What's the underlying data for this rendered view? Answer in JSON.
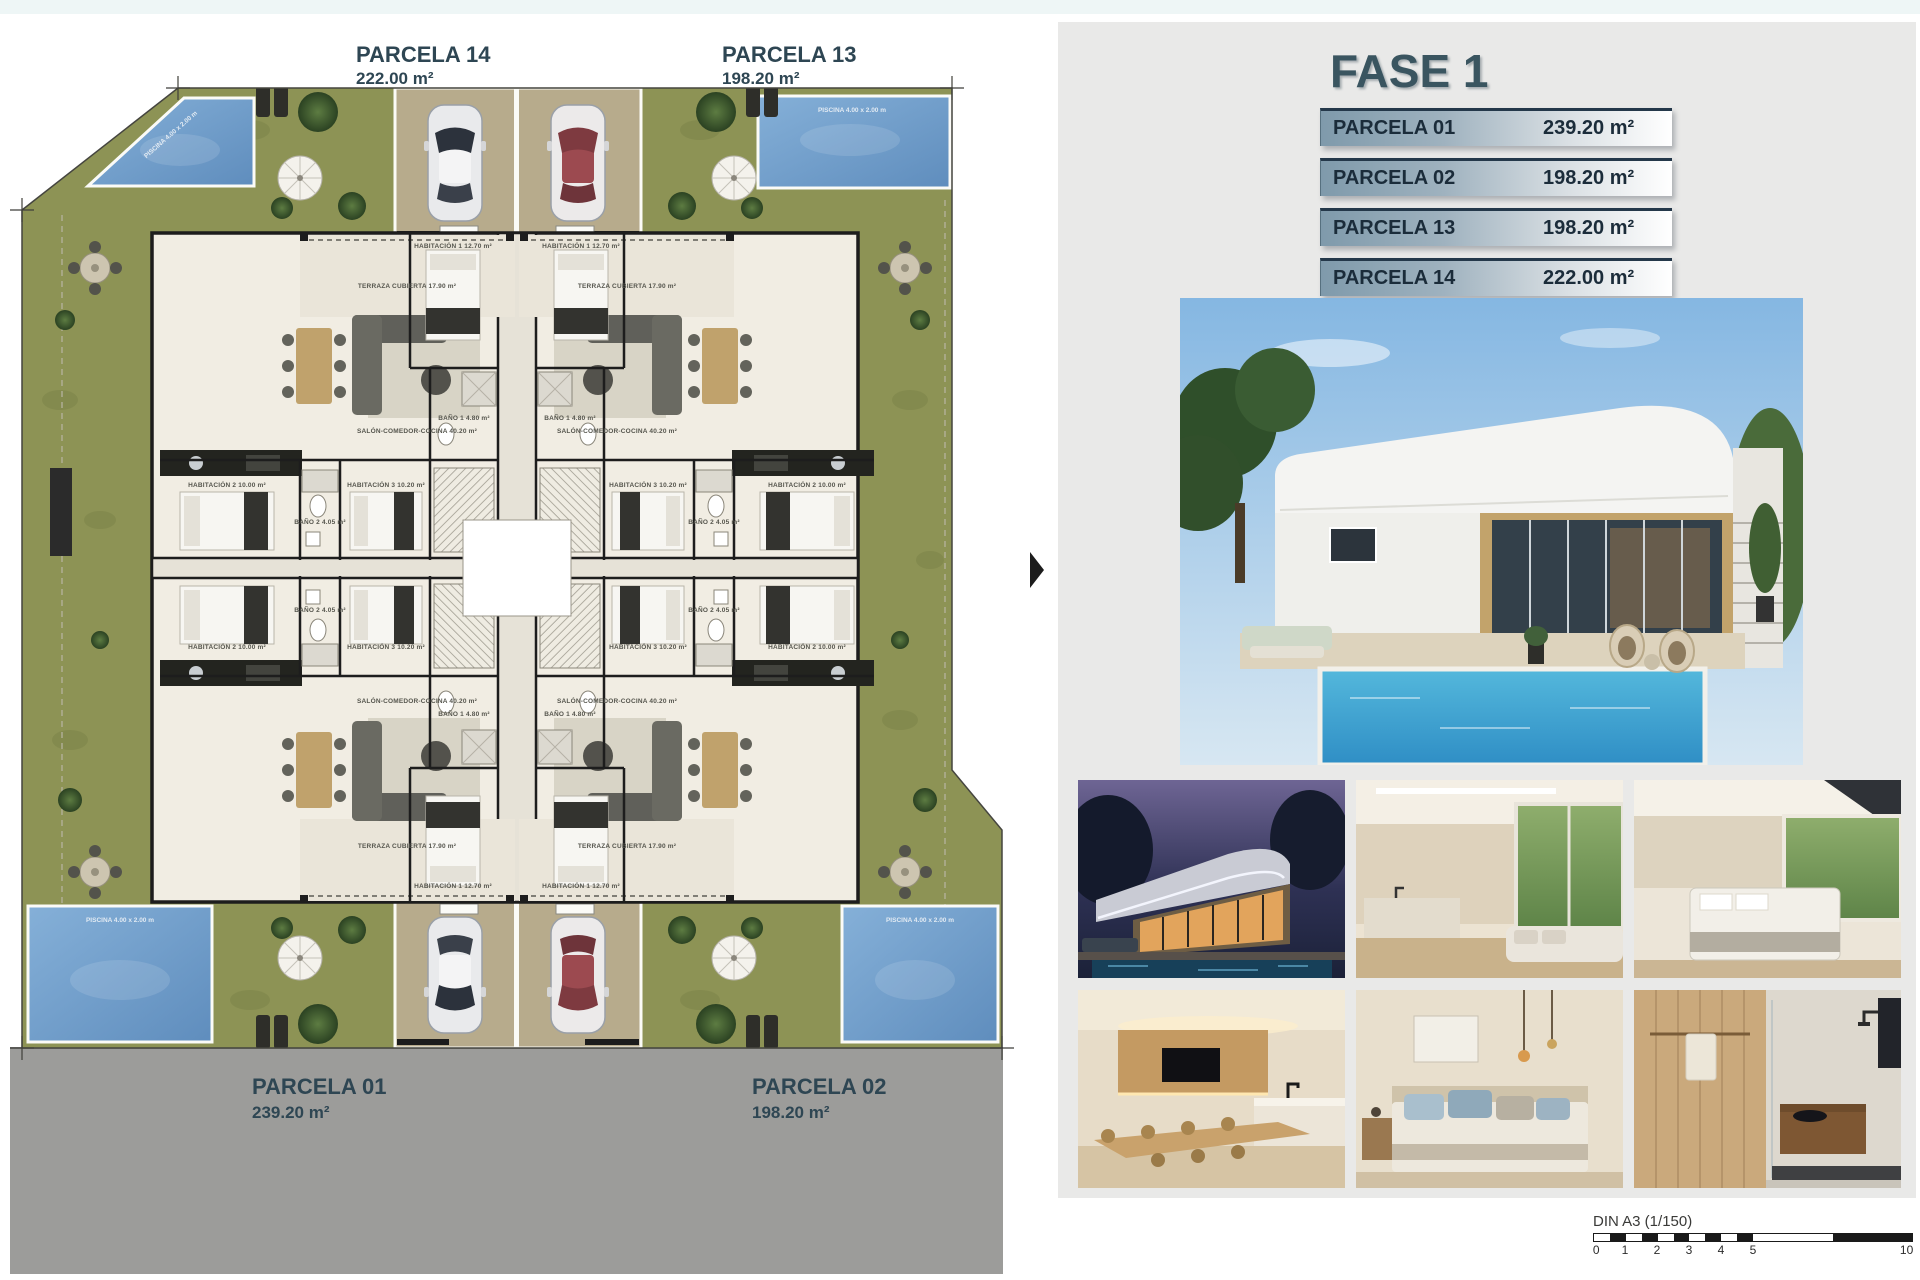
{
  "plan": {
    "parcels": [
      {
        "name": "PARCELA 14",
        "area": "222.00 m²"
      },
      {
        "name": "PARCELA 13",
        "area": "198.20 m²"
      },
      {
        "name": "PARCELA 01",
        "area": "239.20 m²"
      },
      {
        "name": "PARCELA 02",
        "area": "198.20 m²"
      }
    ],
    "rooms": {
      "terraza": "TERRAZA CUBIERTA 17.90 m²",
      "salon": "SALÓN-COMEDOR-COCINA 40.20 m²",
      "hab1": "HABITACIÓN 1 12.70 m²",
      "hab2": "HABITACIÓN 2 10.00 m²",
      "hab3": "HABITACIÓN 3 10.20 m²",
      "bano1": "BAÑO 1 4.80 m²",
      "bano2": "BAÑO 2 4.05 m²",
      "piscina": "PISCINA 4.00 x 2.00 m"
    }
  },
  "panel": {
    "title": "FASE 1",
    "table": [
      {
        "label": "PARCELA 01",
        "value": "239.20 m²"
      },
      {
        "label": "PARCELA 02",
        "value": "198.20 m²"
      },
      {
        "label": "PARCELA 13",
        "value": "198.20 m²"
      },
      {
        "label": "PARCELA 14",
        "value": "222.00 m²"
      }
    ]
  },
  "scalebar": {
    "caption": "DIN A3 (1/150)",
    "ticks": [
      "0",
      "1",
      "2",
      "3",
      "4",
      "5",
      "10"
    ]
  },
  "colors": {
    "accent_slate": "#3a5560",
    "row_text": "#1b2c3a",
    "row_gradient_start": "#7f9aab",
    "panel_bg": "#e9e9e8",
    "site_cream": "#ece8dd",
    "grass": "#8d9355",
    "pool_blue": "#6f9cc9",
    "driveway_tan": "#b7ab8c",
    "road_gray": "#9c9c9a",
    "wall_dark": "#1d1d1d"
  }
}
